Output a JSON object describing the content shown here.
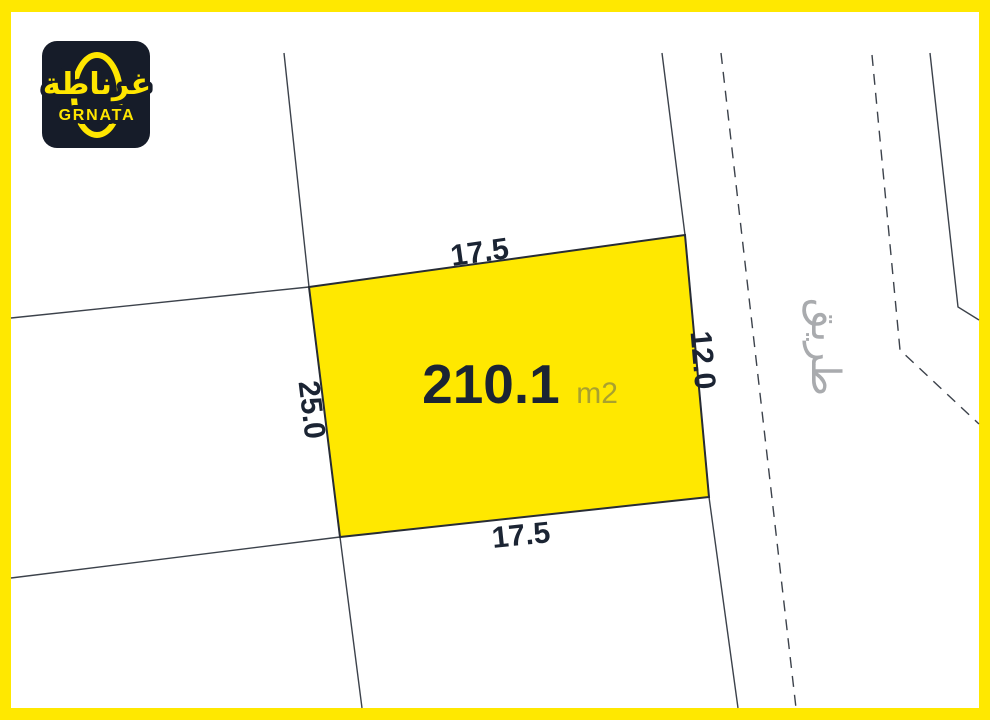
{
  "logo": {
    "arabic_name": "غرناطة",
    "latin_name": "GRNATA"
  },
  "plot": {
    "area_value": "210.1",
    "area_unit": "m2",
    "dimensions": {
      "top": "17.5",
      "bottom": "17.5",
      "left": "25.0",
      "right": "12.0"
    }
  },
  "road": {
    "label_arabic": "طريق"
  },
  "colors": {
    "frame_yellow": "#FFE800",
    "plot_fill_yellow": "#FFE800",
    "logo_background": "#161C29",
    "logo_yellow": "#FFE600",
    "boundary_line": "#3C424B",
    "plot_outline": "#272C35",
    "area_value_text": "#1B2433",
    "area_unit_text": "#A9A12E",
    "dimension_text": "#1B2433",
    "road_text": "#A9ABAE",
    "background_white": "#FFFFFF"
  }
}
